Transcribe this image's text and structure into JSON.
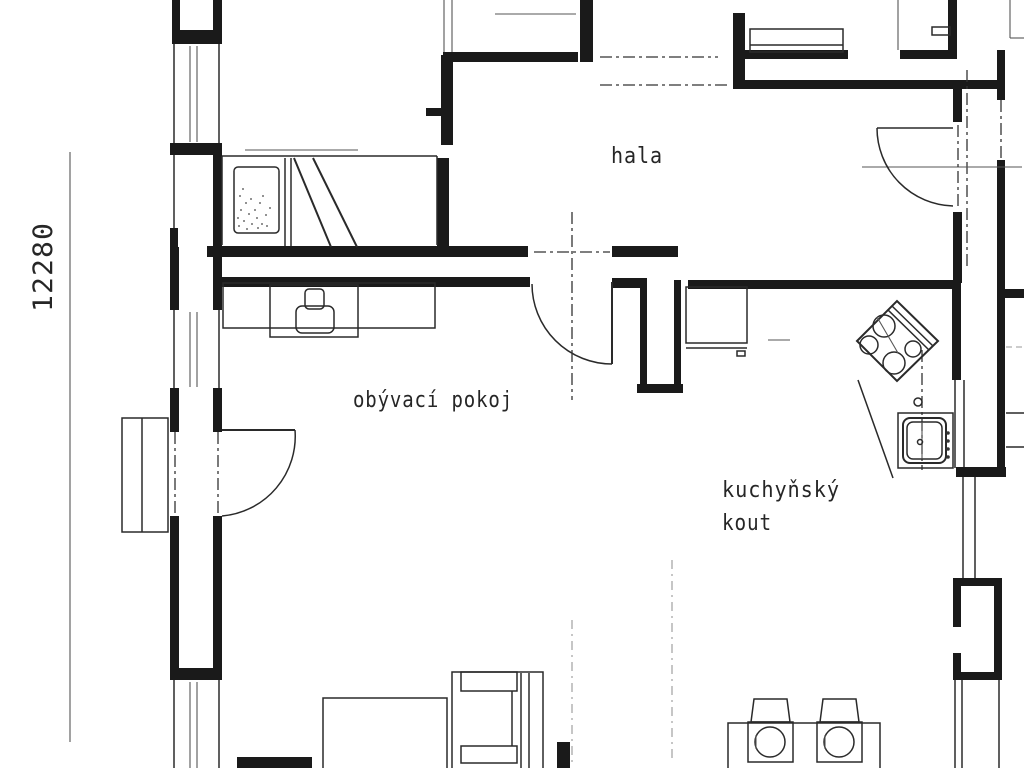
{
  "plan": {
    "type": "floor-plan-drawing",
    "rooms": {
      "hall": {
        "label": "hala"
      },
      "living_room": {
        "label": "obývací pokoj"
      },
      "kitchenette": {
        "label_line1": "kuchyňský",
        "label_line2": "kout"
      }
    },
    "dimensions": {
      "left_vertical": "12280"
    },
    "colors": {
      "background": "#ffffff",
      "ink": "#1a1a1a",
      "text": "#262626"
    }
  }
}
